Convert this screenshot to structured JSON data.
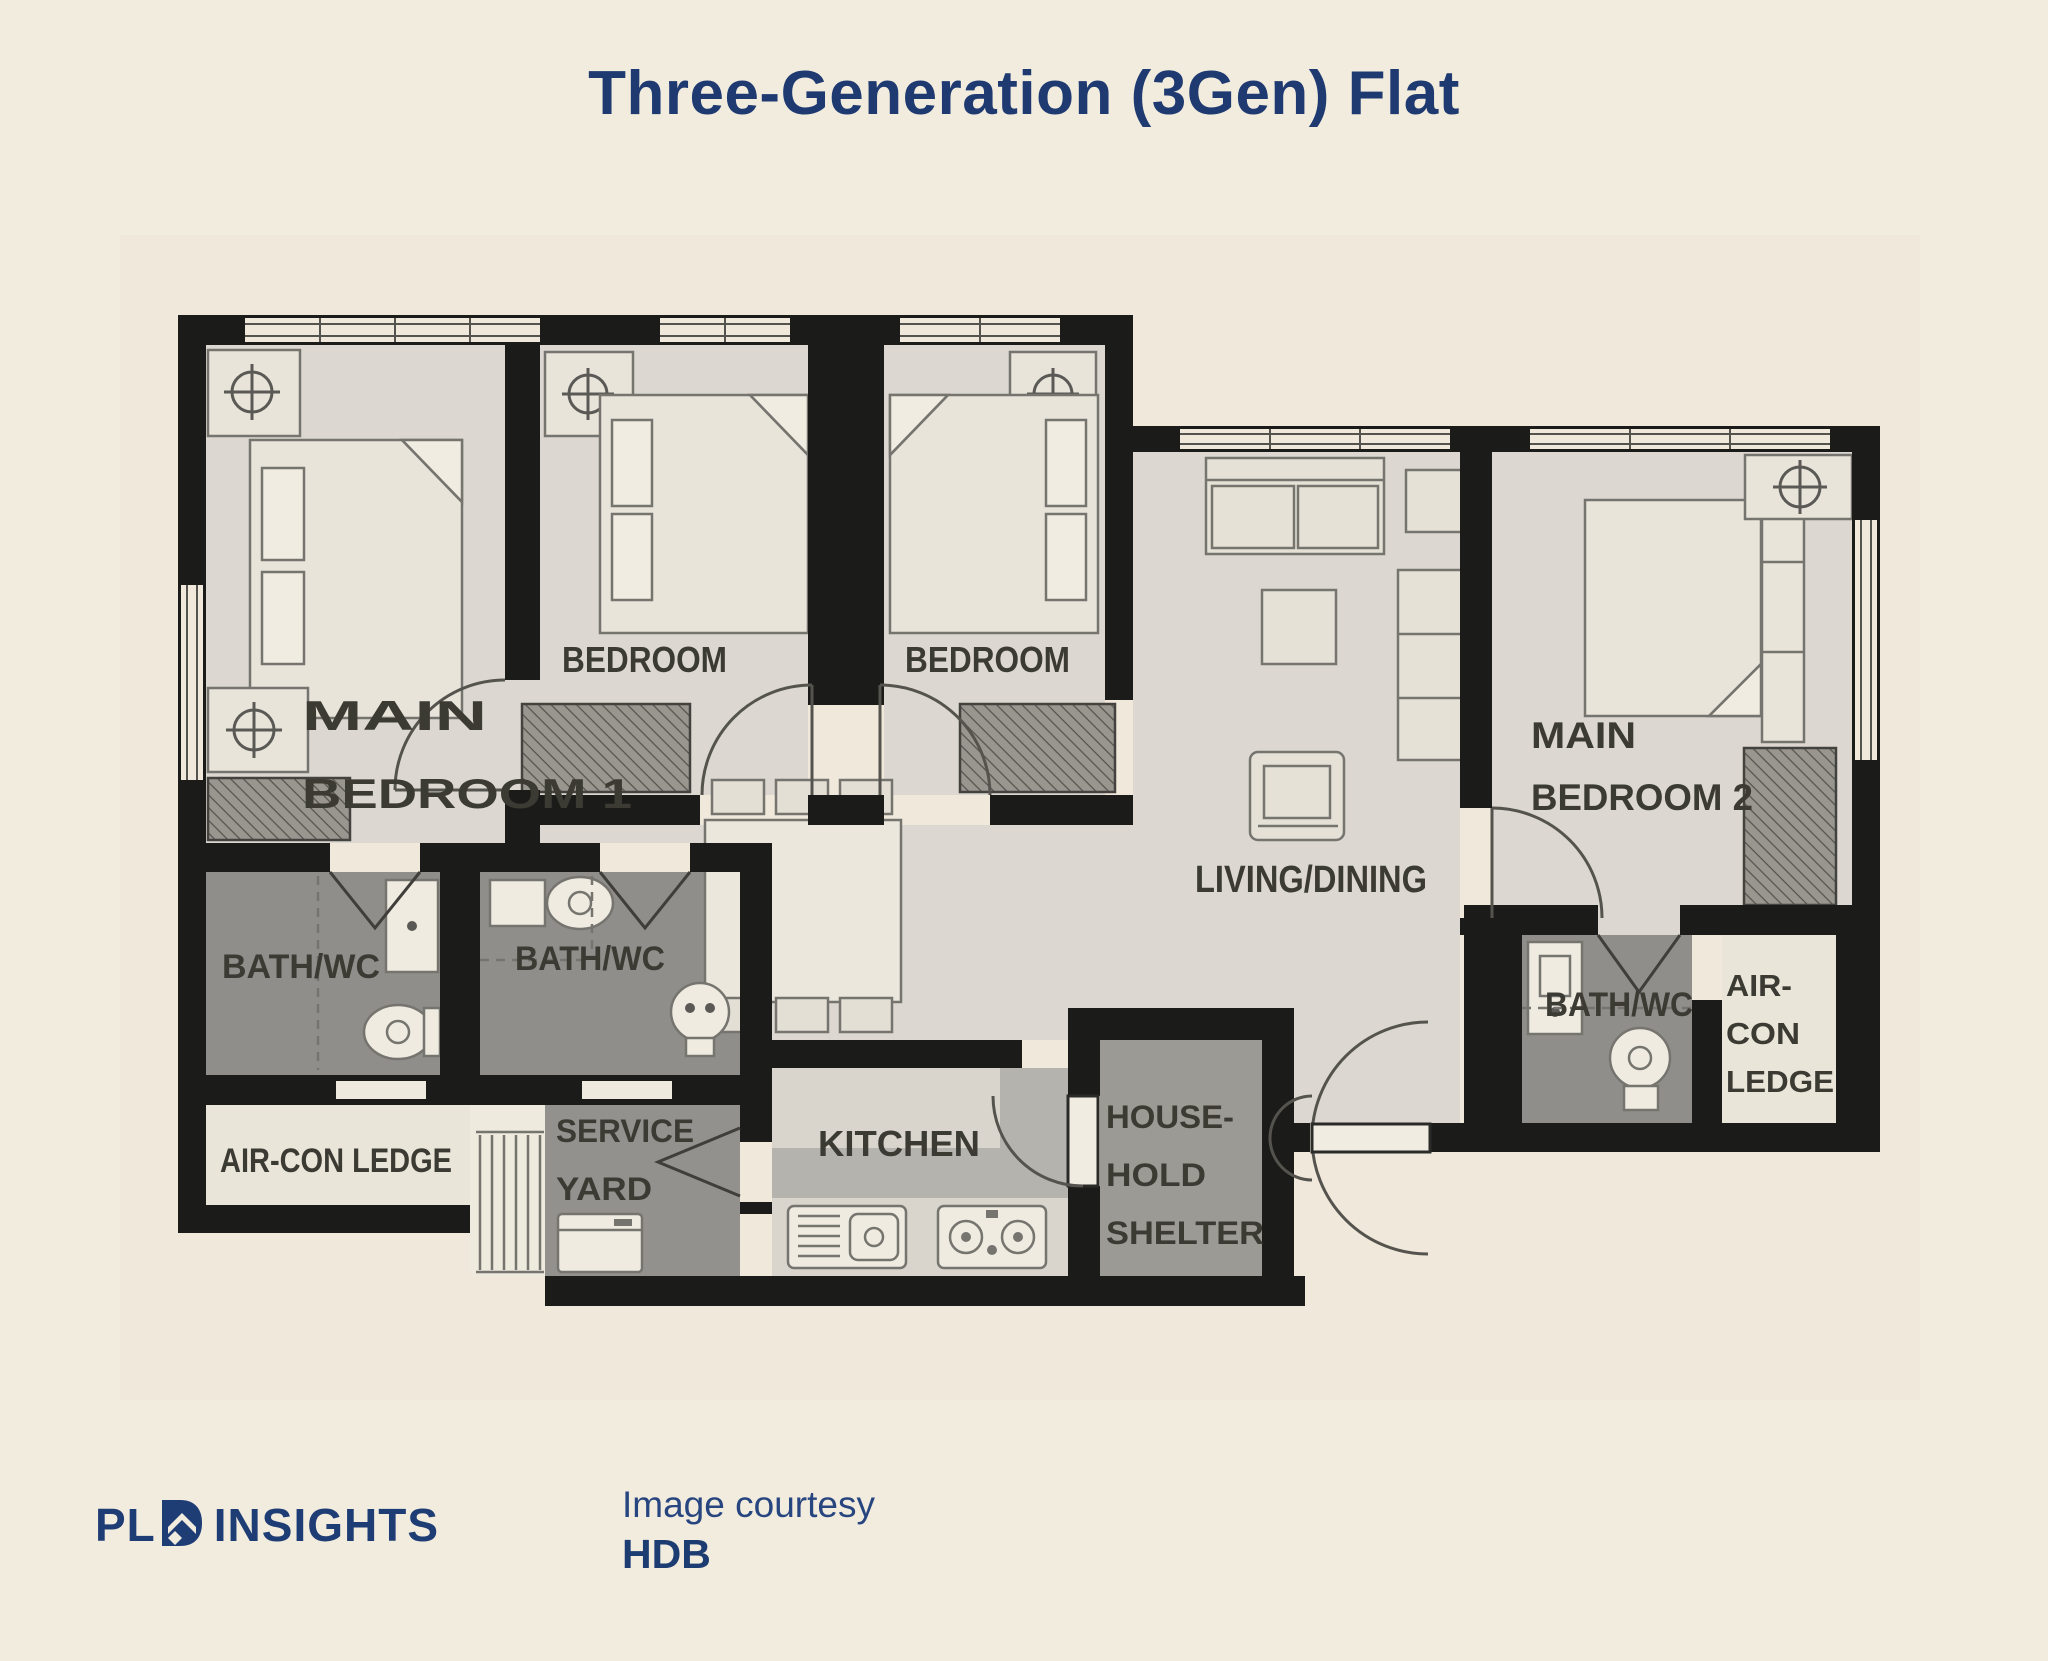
{
  "title": "Three-Generation (3Gen) Flat",
  "plan": {
    "rooms": {
      "main_bedroom_1": {
        "line1": "MAIN",
        "line2": "BEDROOM 1"
      },
      "bedroom_left": {
        "label": "BEDROOM"
      },
      "bedroom_right": {
        "label": "BEDROOM"
      },
      "main_bedroom_2": {
        "line1": "MAIN",
        "line2": "BEDROOM 2"
      },
      "living_dining": {
        "label": "LIVING/DINING"
      },
      "bath_wc_1": {
        "label": "BATH/WC"
      },
      "bath_wc_2": {
        "label": "BATH/WC"
      },
      "bath_wc_3": {
        "label": "BATH/WC"
      },
      "aircon_ledge_left": {
        "label": "AIR-CON LEDGE"
      },
      "aircon_ledge_right": {
        "line1": "AIR-",
        "line2": "CON",
        "line3": "LEDGE"
      },
      "service_yard": {
        "line1": "SERVICE",
        "line2": "YARD"
      },
      "kitchen": {
        "label": "KITCHEN"
      },
      "household_shelter": {
        "line1": "HOUSE-",
        "line2": "HOLD",
        "line3": "SHELTER"
      }
    },
    "colors": {
      "background": "#f2ecdf",
      "wall": "#1b1b19",
      "room_floor": "#dcd8d1",
      "bath_floor": "#908e8a",
      "kitchen_floor": "#b5b3ae",
      "counter": "#d9d5cc",
      "shelter_floor": "#9c9a95",
      "ledge_floor": "#eae5d9",
      "label_text": "#3b3a33"
    }
  },
  "footer": {
    "logo_text_left": "PL",
    "logo_text_right": "INSIGHTS",
    "credit_line1": "Image courtesy",
    "credit_line2": "HDB",
    "brand_navy": "#1f3d75"
  }
}
